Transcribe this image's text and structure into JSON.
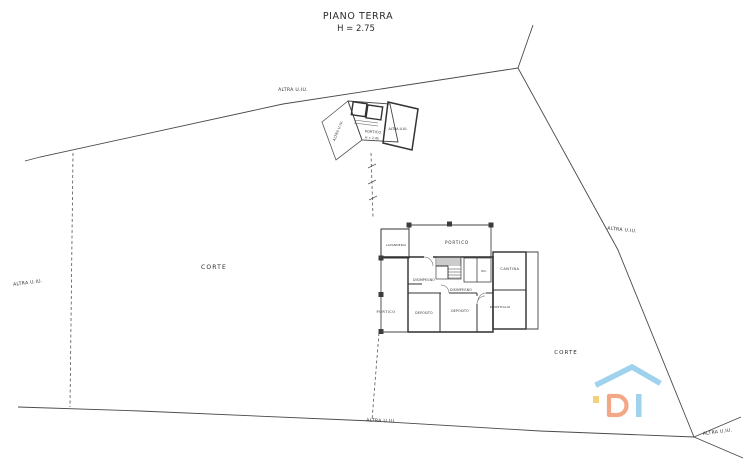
{
  "title": {
    "text": "PIANO TERRA",
    "height": "H = 2.75"
  },
  "site": {
    "corte_left": "CORTE",
    "corte_right": "CORTE",
    "altra_top": "ALTRA U.IU.",
    "altra_left": "ALTRA U.IU.",
    "altra_right": "ALTRA U.IU.",
    "altra_bottom": "ALTRA U.IU.",
    "altra_bottom_right": "ALTRA U.IU."
  },
  "outbuilding": {
    "altra_strip": "ALTRA U.IU.",
    "portico": "PORTICO",
    "portico_h": "H = 2.45",
    "altra_right": "ALTRA U.IU."
  },
  "building": {
    "lavanderia": "LAVANDERIA",
    "portico_top": "PORTICO",
    "portico_left": "PORTICO",
    "disimpegno_a": "DISIMPEGNO",
    "disimpegno_b": "DISIMPEGNO",
    "wc": "W.C.",
    "cantina": "CANTINA",
    "ripostiglio": "RIPOSTIGLIO",
    "deposito_a": "DEPOSITO",
    "deposito_b": "DEPOSITO"
  },
  "watermark": {
    "roof_color": "#7fc3e6",
    "d_color": "#ee8c5f",
    "i_color": "#7fc3e6",
    "accent_color": "#f2c14e"
  }
}
